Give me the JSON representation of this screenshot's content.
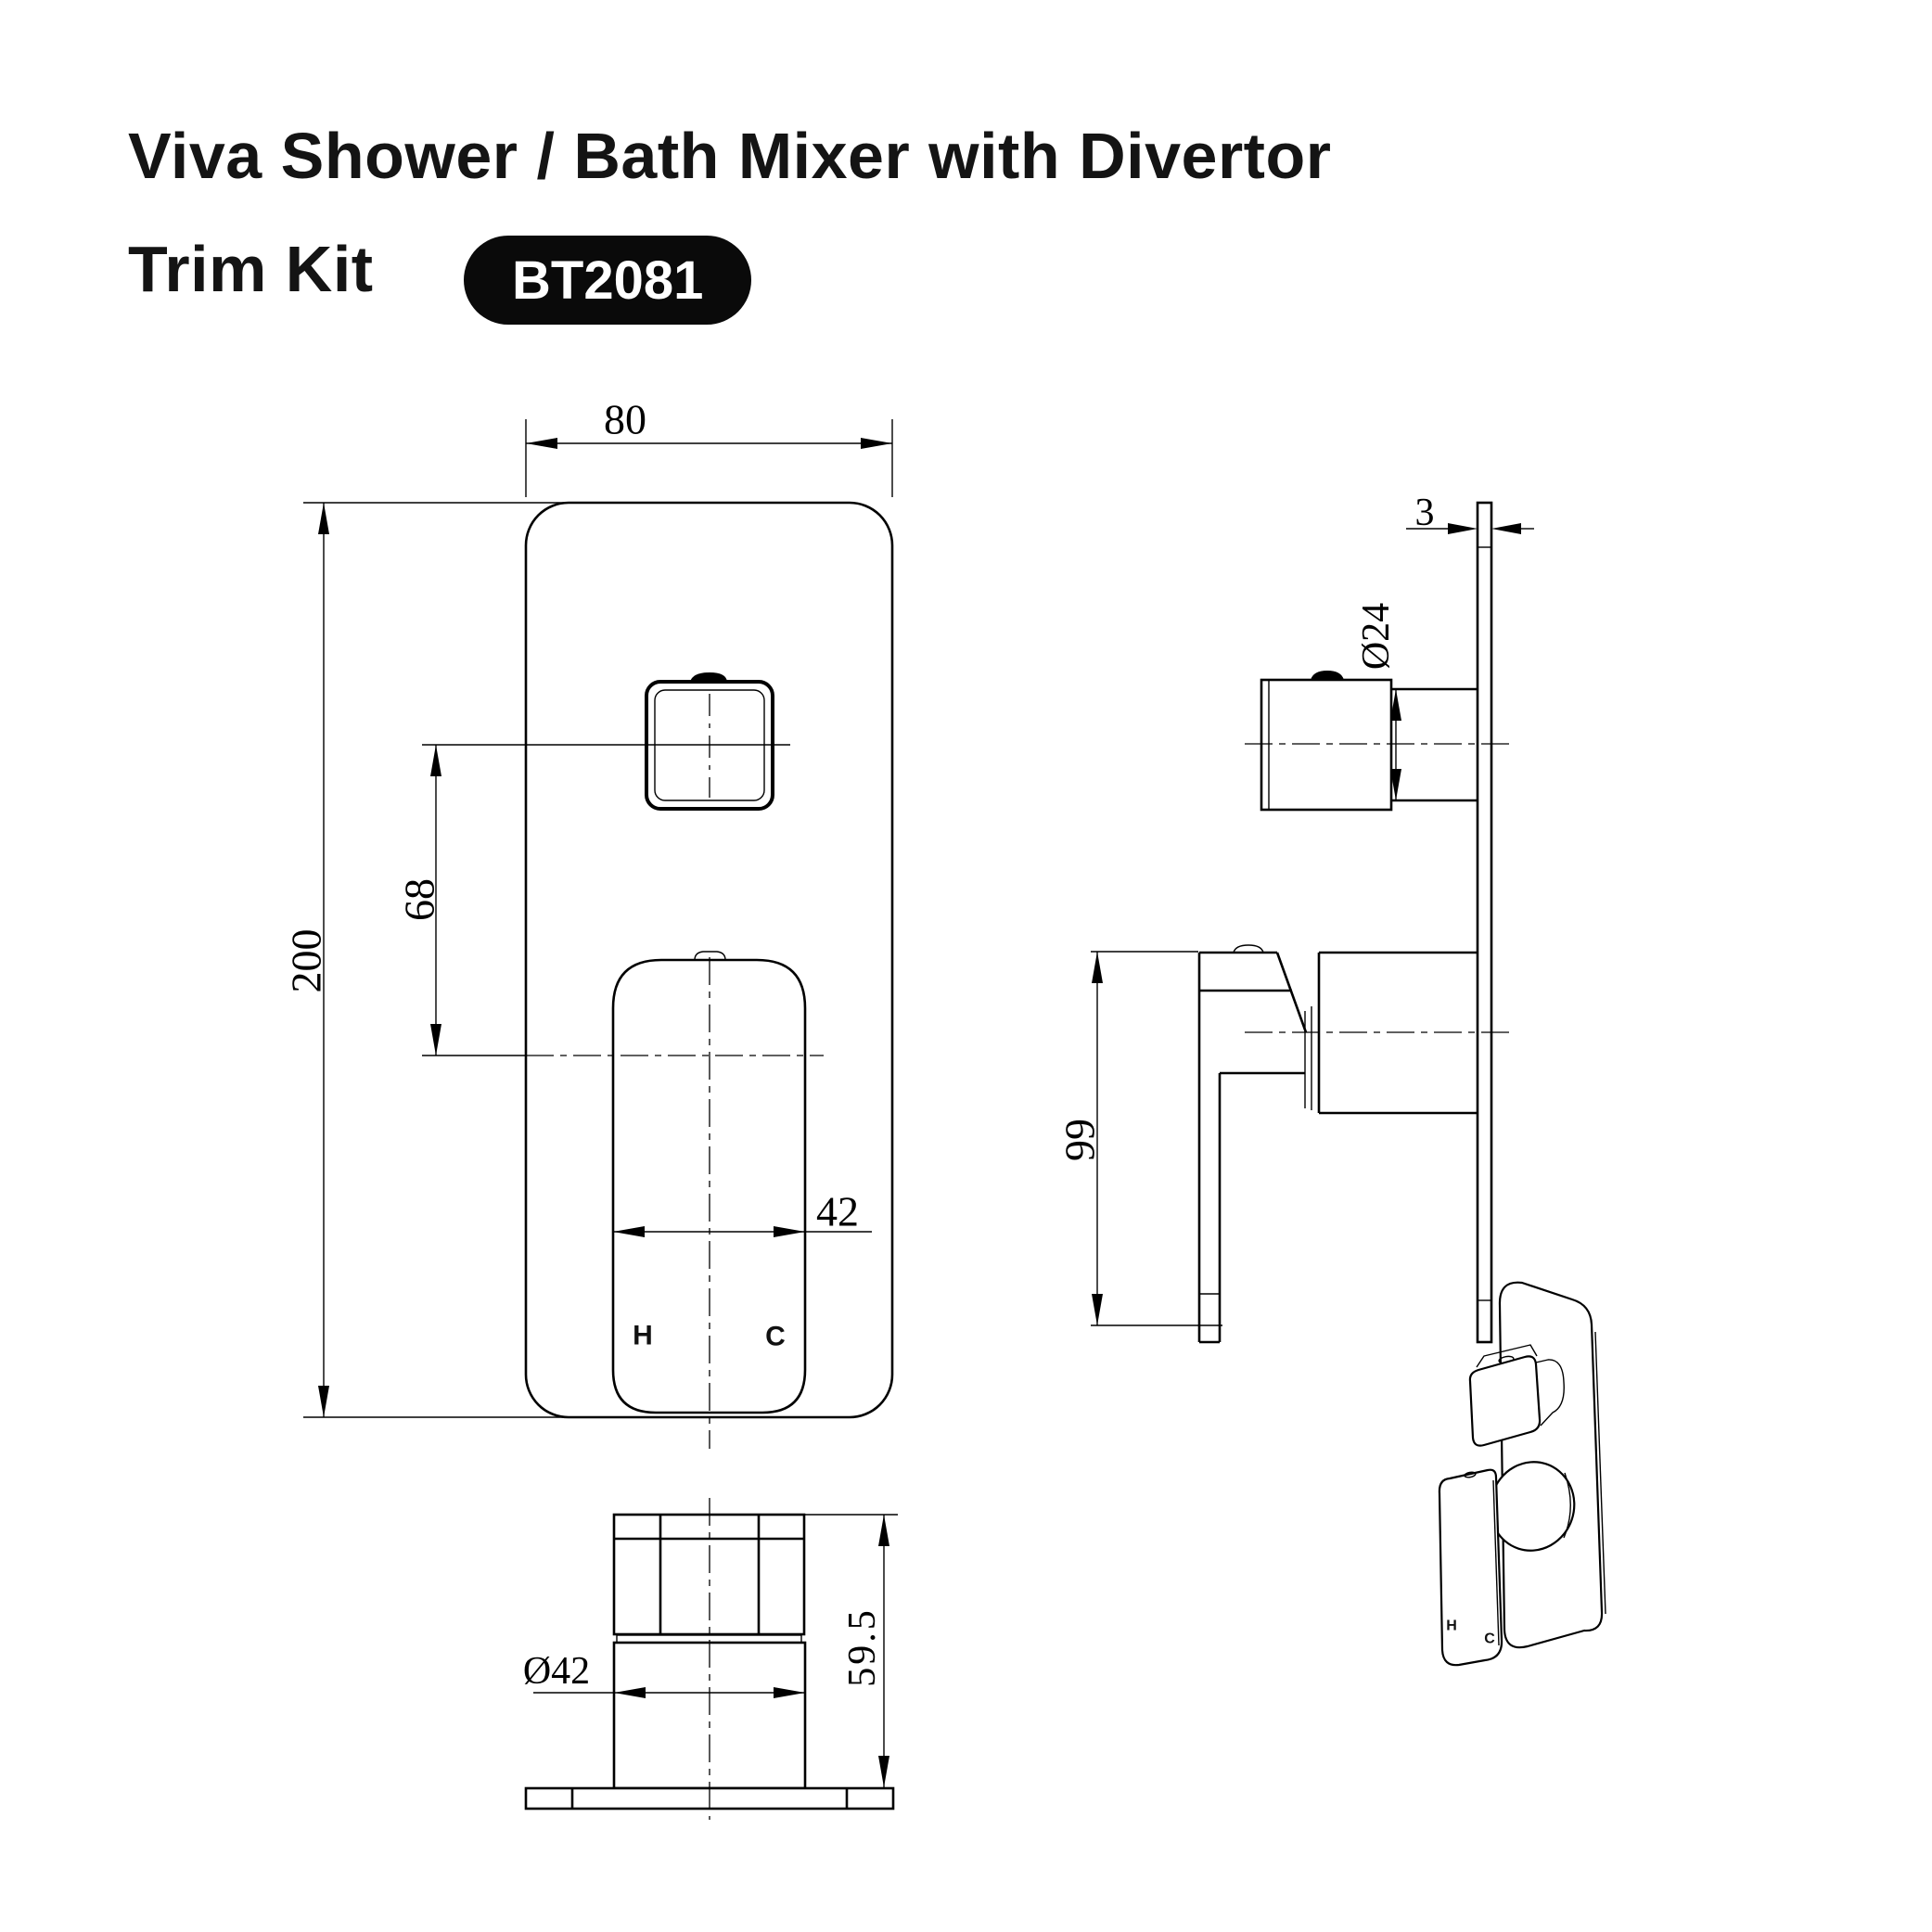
{
  "page": {
    "background": "#ffffff",
    "line_color": "#000000"
  },
  "header": {
    "title_line1": "Viva Shower / Bath Mixer with Divertor",
    "title_line2": "Trim Kit",
    "model": "BT2081",
    "badge_bg": "#0a0a0a",
    "badge_text_color": "#ffffff"
  },
  "views": {
    "front": {
      "dim_width": "80",
      "dim_height": "200",
      "dim_button_to_handle": "68",
      "dim_handle_width": "42",
      "label_hot": "H",
      "label_cold": "C"
    },
    "side": {
      "dim_plate_thickness": "3",
      "dim_knob_diameter": "Ø24",
      "dim_handle_height": "99"
    },
    "bottom": {
      "dim_base_diameter": "Ø42",
      "dim_total_height": "59.5"
    },
    "perspective": {
      "label_hot": "H",
      "label_cold": "C"
    }
  }
}
